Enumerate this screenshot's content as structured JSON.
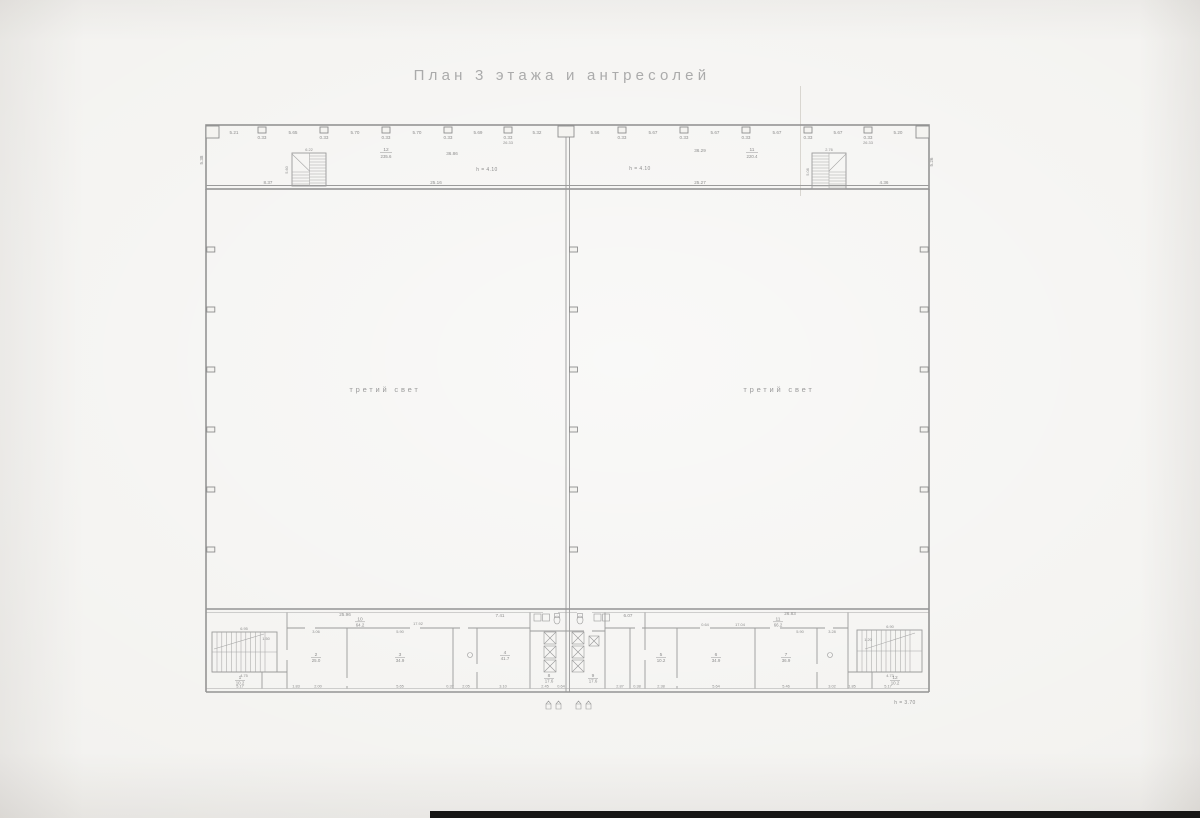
{
  "title": "План 3 этажа и антресолей",
  "colors": {
    "paper": "#f1f0ed",
    "line": "#9a9a9a",
    "text": "#8d8d8d"
  },
  "mezzanine_left": {
    "room_no": "12",
    "room_area": "235.6",
    "width_label": "36.86",
    "height_note": "h = 4.10",
    "dims_top": [
      "5.21",
      "0.33",
      "5.65",
      "0.33",
      "5.70",
      "0.33",
      "5.70",
      "0.33",
      "5.69",
      "0.33",
      "5.32"
    ],
    "dim_stacked": "26.33",
    "stair": {
      "width": "6.22",
      "height": "5.60"
    },
    "left_wall_dim": "5.38",
    "dims_bottom": [
      "8.37",
      "25.16"
    ]
  },
  "mezzanine_right": {
    "room_no": "11",
    "room_area": "220.4",
    "width_label": "36.29",
    "height_note": "h = 4.10",
    "dims_top": [
      "5.56",
      "0.33",
      "5.67",
      "0.33",
      "5.67",
      "0.33",
      "5.67",
      "0.33",
      "5.67",
      "0.33",
      "5.20"
    ],
    "dim_stacked": "26.33",
    "stair": {
      "width": "2.76",
      "height": "5.08"
    },
    "right_wall_dim": "5.26",
    "dims_bottom": [
      "25.27",
      "4.36"
    ]
  },
  "halls": {
    "left_label": "третий свет",
    "right_label": "третий свет"
  },
  "ground_floor": {
    "height_note": "h = 3.70",
    "dims_top": [
      "25.96",
      "7.41",
      "6.07",
      "26.83"
    ],
    "dims_inner": [
      "3.06",
      "5.90",
      "17.92",
      "6.95",
      "4.75",
      "0.64",
      "17.04",
      "5.90",
      "3.28",
      "6.90",
      "4.73",
      "1.50",
      "1.20"
    ],
    "dims_bottom": [
      "5.17",
      "1.83",
      "2.00",
      "5.65",
      "0.37",
      "2.05",
      "3.10",
      "2.45",
      "0.64",
      "2.87",
      "0.38",
      "2.38",
      "5.64",
      "5.46",
      "3.02",
      "1.85",
      "5.17"
    ],
    "rooms": [
      {
        "no": "10",
        "area": "64.2"
      },
      {
        "no": "1",
        "area": "10.2"
      },
      {
        "no": "2",
        "area": "25.0"
      },
      {
        "no": "3",
        "area": "34.9"
      },
      {
        "no": "4",
        "area": "41.7"
      },
      {
        "no": "8",
        "area": "17.6"
      },
      {
        "no": "9",
        "area": "17.6"
      },
      {
        "no": "11",
        "area": "66.2"
      },
      {
        "no": "5",
        "area": "10.2"
      },
      {
        "no": "6",
        "area": "34.9"
      },
      {
        "no": "7",
        "area": "36.9"
      },
      {
        "no": "12",
        "area": "10.2"
      }
    ]
  }
}
